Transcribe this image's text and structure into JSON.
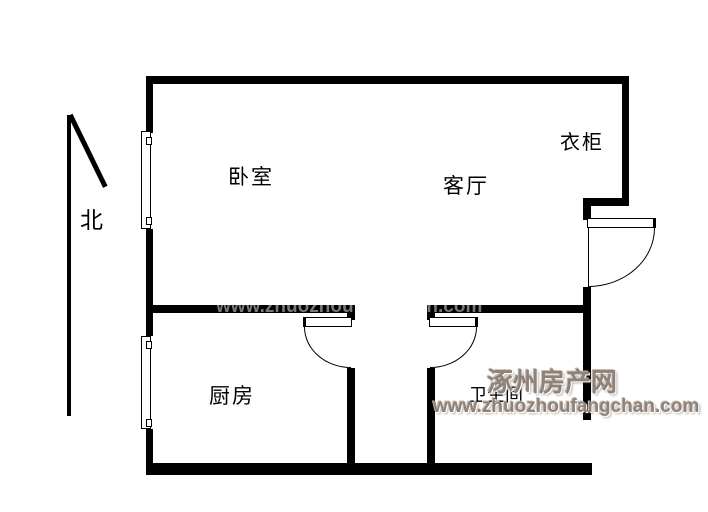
{
  "compass": {
    "label": "北"
  },
  "rooms": {
    "bedroom": {
      "label": "卧室"
    },
    "living": {
      "label": "客厅"
    },
    "wardrobe": {
      "label": "衣柜"
    },
    "kitchen": {
      "label": "厨房"
    },
    "bathroom": {
      "label": "卫生间"
    }
  },
  "watermark": {
    "site_name": "涿州房产网",
    "site_url": "www.zhuozhoufangchan.com",
    "color": "#8e8279"
  },
  "colors": {
    "wall": "#000000",
    "background": "#ffffff"
  }
}
